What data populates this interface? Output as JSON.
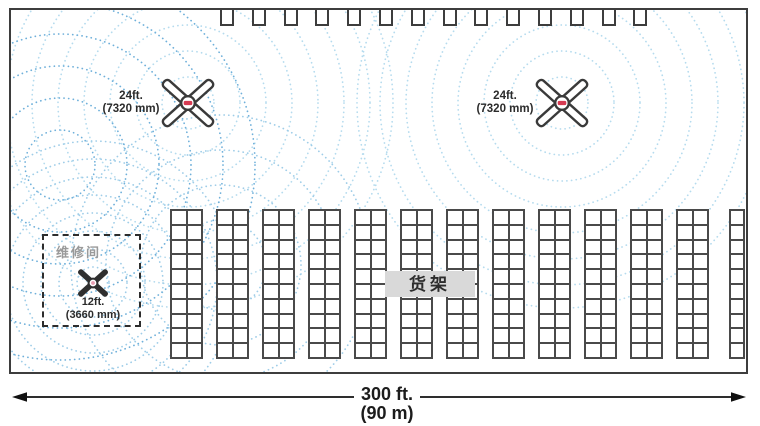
{
  "labels": {
    "fan24_line1": "24ft.",
    "fan24_line2": "(7320 mm)",
    "fan12_line1": "12ft.",
    "fan12_line2": "(3660 mm)",
    "repair_room": "维修间",
    "racks": "货架",
    "dim_line1": "300 ft.",
    "dim_line2": "(90 m)"
  },
  "colors": {
    "outline": "#3d3d3d",
    "rack_line": "#4a4a4a",
    "ring_light": "#b5dbee",
    "ring_soft": "#9fcde8",
    "ring_medium": "#6fb0da",
    "label_bg": "#d9d9d9",
    "repair_text": "#9a9a9a",
    "text": "#2b2b2b",
    "hub_accent": "#d63a52"
  },
  "diagram": {
    "airflow": [
      {
        "name": "fan-24ft-left-coverage",
        "cx": 177,
        "cy": 93,
        "radii": [
          26,
          52,
          78,
          104,
          130,
          156,
          182,
          205
        ],
        "color": "ring_light"
      },
      {
        "name": "fan-24ft-right-coverage",
        "cx": 551,
        "cy": 93,
        "radii": [
          26,
          52,
          78,
          104,
          130,
          156,
          182,
          205
        ],
        "color": "ring_light"
      },
      {
        "name": "fan-12ft-coverage",
        "cx": 82,
        "cy": 273,
        "radii": [
          16,
          34,
          52,
          70,
          88,
          106,
          124,
          142
        ],
        "color": "ring_soft"
      },
      {
        "name": "crossflow-arcs-a",
        "cx": 49,
        "cy": 155,
        "radii": [
          35,
          67,
          99,
          131,
          163,
          195
        ],
        "color": "ring_medium"
      },
      {
        "name": "crossflow-arcs-b",
        "cx": 210,
        "cy": 255,
        "radii": [
          45,
          80,
          115,
          150
        ],
        "color": "ring_soft"
      }
    ],
    "docks": {
      "count": 14,
      "start_x": 209,
      "pitch": 31.8,
      "width": 10,
      "height": 14
    },
    "racks": {
      "double_count": 12,
      "start_x": 159,
      "pitch": 46,
      "width": 33,
      "rows": 10,
      "cols": 2,
      "single": {
        "x": 718,
        "width": 16,
        "cols": 1
      }
    }
  }
}
